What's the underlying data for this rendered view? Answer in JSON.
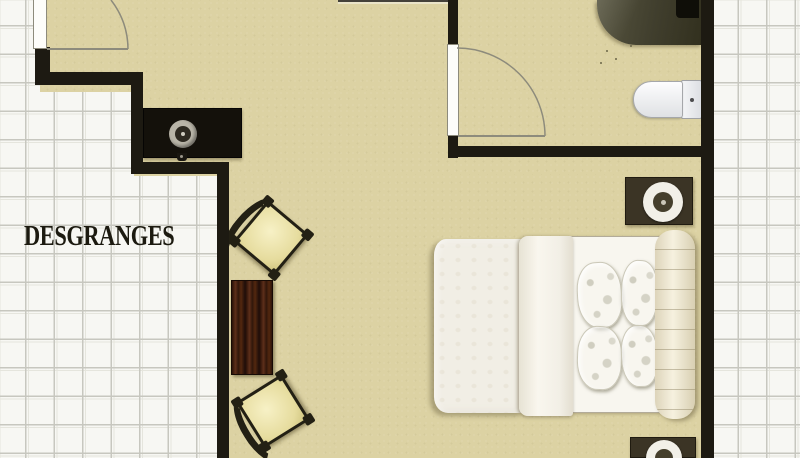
{
  "plan": {
    "room_label": "DESGRANGES",
    "colors": {
      "floor": "#dcd2a3",
      "wall": "#1d1a12",
      "grid_background": "#f7f7f3",
      "grid_line": "#c7c7bf",
      "label_text": "#1c1a10",
      "door_swing_line": "#8d8b7c",
      "shower_unit": "#403e2d",
      "wood_table": "#3a1d0f",
      "nightstand": "#3b3425",
      "chair_cushion": "#ece5ab",
      "bedding_white": "#f1eee5",
      "headboard_cream": "#e9e2ca"
    },
    "furniture": {
      "entry_door": "entry-door-open",
      "bathroom_door": "bathroom-door-open",
      "shower": "corner-shower-unit",
      "toilet": "toilet",
      "console": "console-with-round-lamp",
      "armchair_upper": "armchair-with-curved-back",
      "armchair_lower": "armchair-with-curved-back",
      "side_table": "dark-wood-side-table",
      "bed": "double-bed-with-duvet",
      "pillows": "four-damask-pillows",
      "headboard": "rolled-bolster-headboard",
      "nightstand_upper": "nightstand-with-lamp",
      "nightstand_lower": "nightstand-with-lamp"
    }
  }
}
